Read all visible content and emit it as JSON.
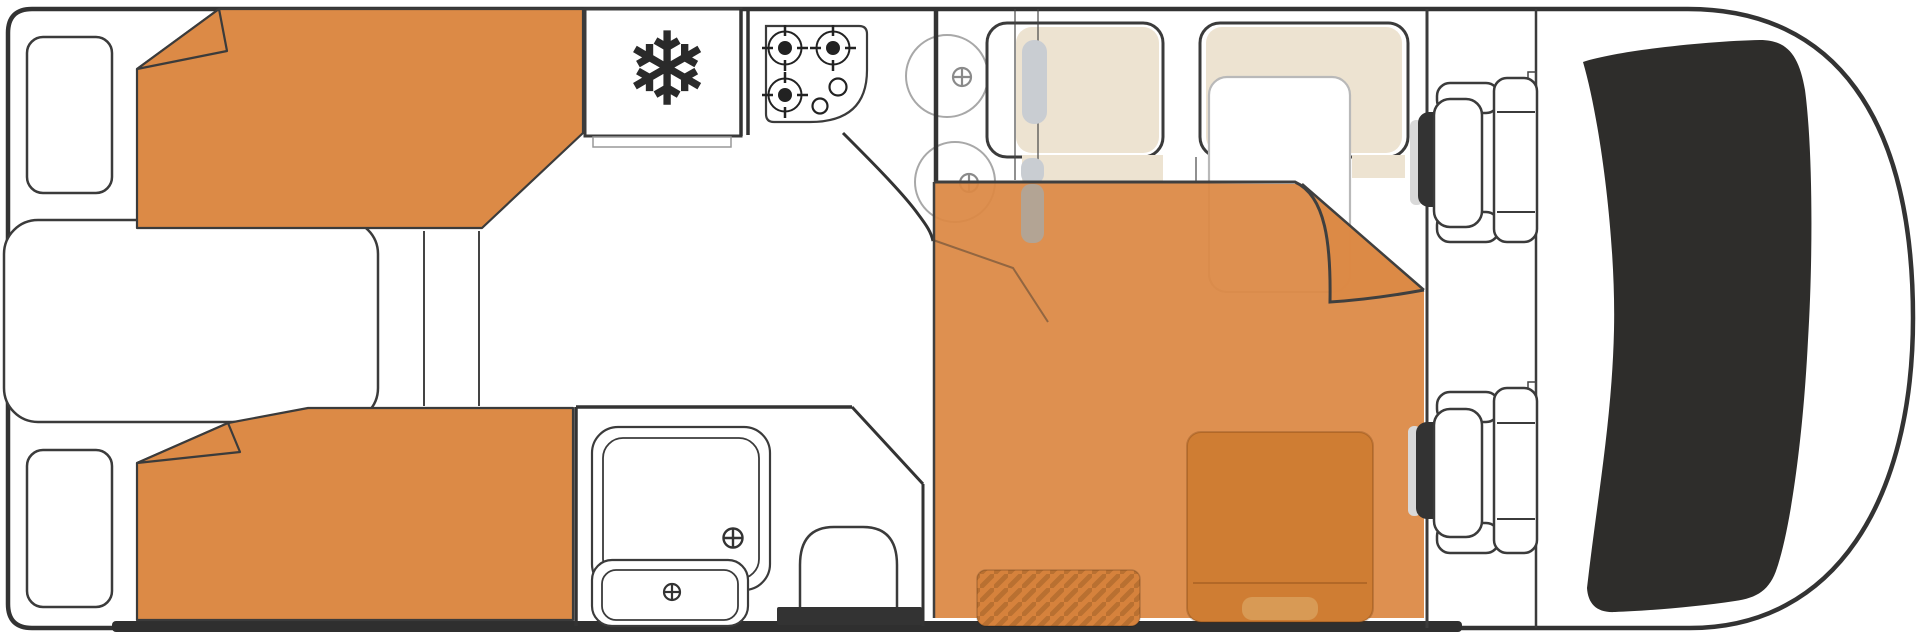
{
  "diagram": {
    "type": "motorhome-floorplan",
    "view": "top-down"
  },
  "icons": {
    "snowflake": "❄"
  },
  "colors": {
    "outline": "#333333",
    "wall": "#3b3b3b",
    "white": "#ffffff",
    "blanket_orange": "#DC8A46",
    "bed_overlay_orange": "rgba(220,137,69,0.94)",
    "cushion_beige": "#EDE3D1",
    "windshield_dark": "#2E2D2B",
    "door_handle_dark": "#333333",
    "toilet_base_dark": "#333333",
    "chassis_dark": "#2F2F2F",
    "under_bed_table_orange": "#CF7D33",
    "under_bed_table_pill": "#D89A55",
    "entry_mat_orange": "#D6823C",
    "mat_stripe": "rgba(101,58,15,0.25)",
    "seatbelt_gray": "#C9CDD2",
    "seatbelt_ghost_gray": "#B3A494",
    "door_gray": "#D9D9D9",
    "table_stroke_gray": "#B9B9B9",
    "sink_gray": "#A8A8A8"
  },
  "areas": {
    "rear_bedroom": "twin single beds",
    "kitchen": "fridge, stove, sink",
    "bathroom": "shower, basin, toilet",
    "dinette": "bench seats converted to bed",
    "cab": "driver and passenger seats"
  }
}
